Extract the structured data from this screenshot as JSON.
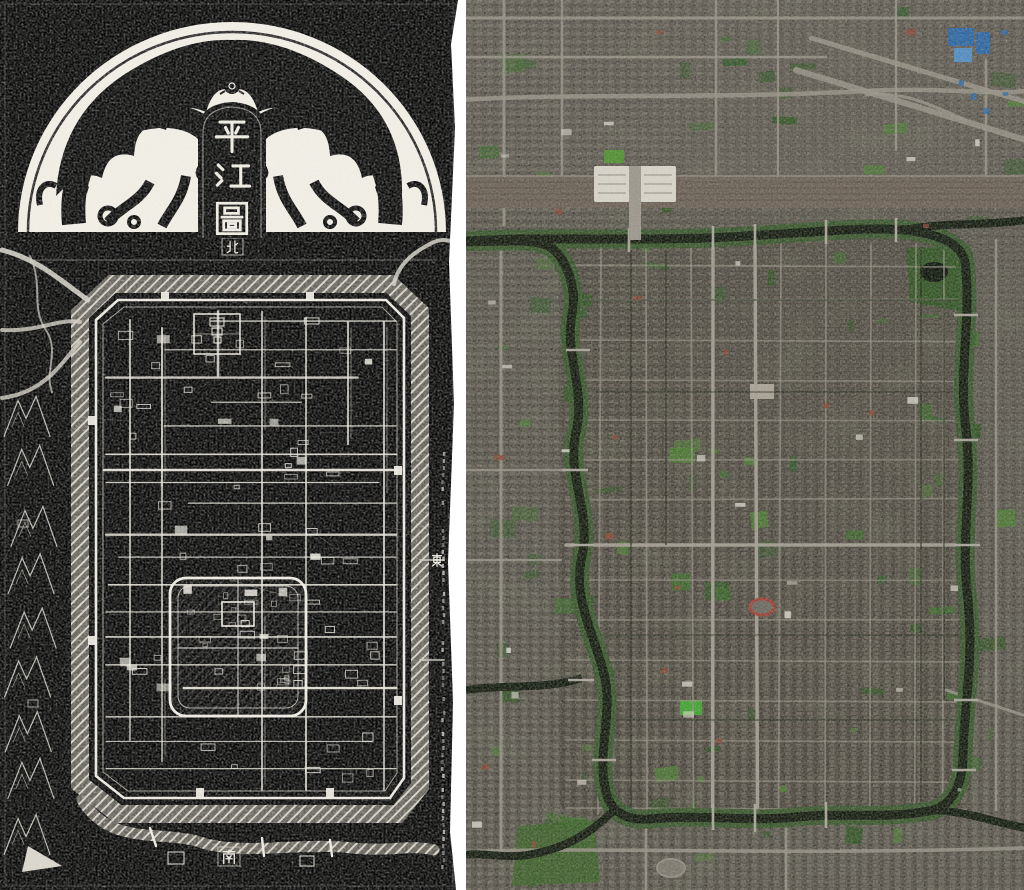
{
  "left_panel": {
    "title": "平江圖",
    "title_chars": [
      "平",
      "江",
      "圖"
    ],
    "compass": {
      "north": "北",
      "south": "南",
      "east": "東"
    },
    "colors": {
      "background": "#070707",
      "ink": "#edeae1",
      "moat_fill": "#716f67",
      "arch_fill": "#efece3"
    }
  },
  "right_panel": {
    "colors": {
      "base": "#57544b",
      "old_city_tint": "#453f38",
      "water": "#131b0f",
      "canal_bank": "#35562a",
      "vegetation": "#3c6a2b",
      "vegetation_bright": "#3fa32e",
      "road": "#979286",
      "main_road": "#a39e92",
      "railway": "#6b6055",
      "building_light": "#d9d6cc",
      "roof_red": "#8a4632",
      "roof_blue": "#2c66a3",
      "track_red": "#9c4036"
    }
  },
  "divider": {
    "color": "#ffffff"
  }
}
